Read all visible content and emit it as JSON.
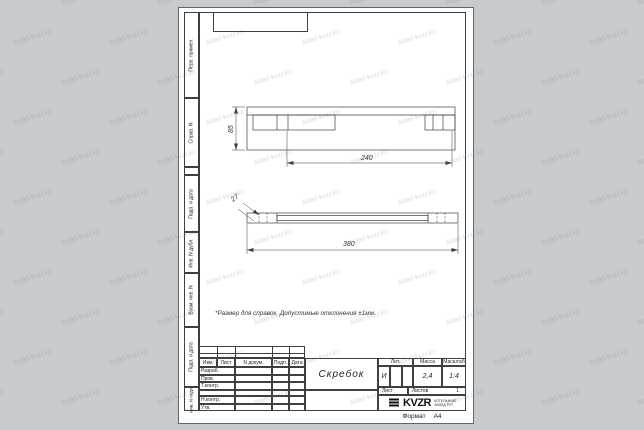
{
  "colors": {
    "background": "#c7cbce",
    "paper": "#ffffff",
    "line": "#3f3f3f"
  },
  "watermark": {
    "text": "kotel-kvzr.kz"
  },
  "margin_labels": [
    "Перв. примен.",
    "Справ. N",
    "Подп. и дата",
    "Инв. N дубл.",
    "Взам. инв. N",
    "Подп. и дата",
    "Инв. N подл."
  ],
  "note": "*Размер для справок. Допустимые отклонения ±1мм.",
  "drawing": {
    "dims": {
      "top_height": "85",
      "top_length": "240",
      "front_height": "27",
      "front_length": "380"
    }
  },
  "title_block": {
    "header_cols": [
      "Изм.",
      "Лист",
      "N докум.",
      "Подп.",
      "Дата"
    ],
    "approval_rows": [
      "Разраб.",
      "Пров.",
      "Т.контр.",
      "Н.контр.",
      "Утв."
    ],
    "part_name": "Скребок",
    "lit_label": "Лит.",
    "lit_value": "И",
    "mass_label": "Масса",
    "mass_value": "2,4",
    "scale_label": "Масштаб",
    "scale_value": "1:4",
    "sheet_label": "Лист",
    "sheets_label": "Листов",
    "sheets_value": "1",
    "company": {
      "logo_text": "KVZR",
      "tagline_line1": "КОТЕЛЬНЫЙ",
      "tagline_line2": "ЗАВОД РЗТ"
    }
  },
  "footer": {
    "format_label": "Формат",
    "format_value": "А4"
  }
}
